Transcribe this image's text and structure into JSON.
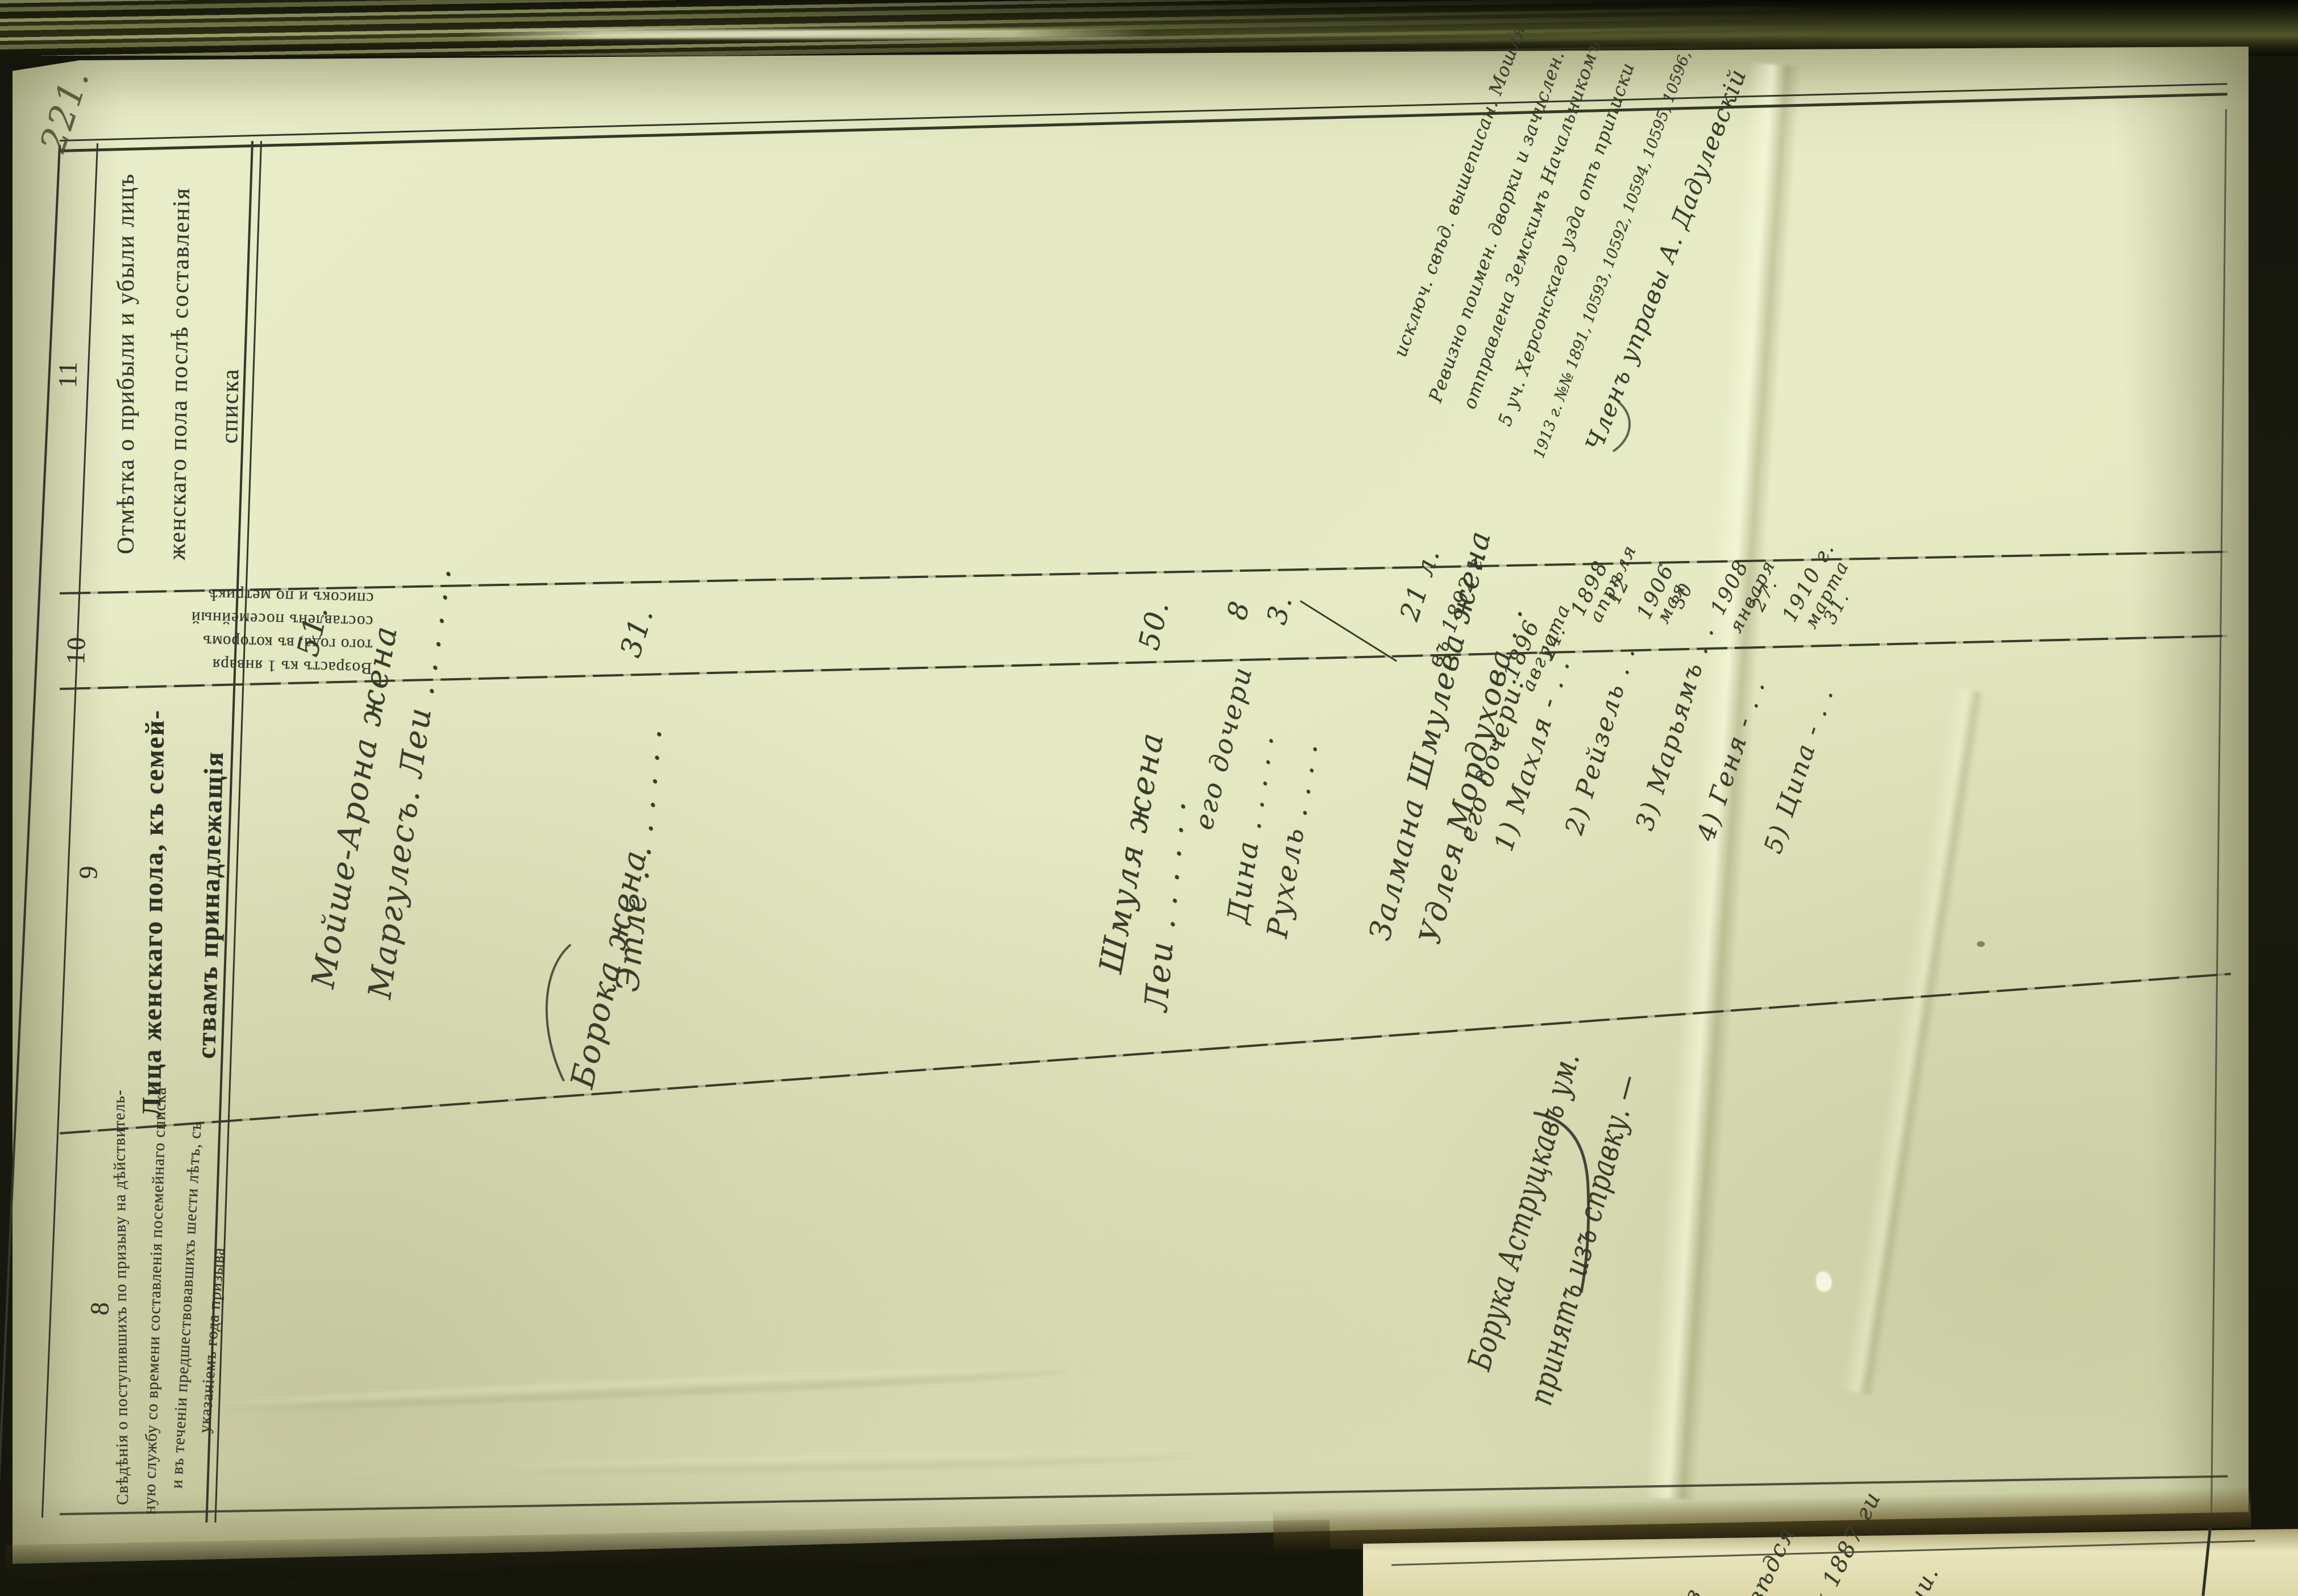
{
  "colors": {
    "paper": "#e7ebc6",
    "ink_print": "#31352a",
    "ink_hand": "#3a3c2b",
    "book_edge": "#3c3f1f",
    "background": "#14150c"
  },
  "page_mark": "221.",
  "columns": {
    "c11": {
      "number": "11",
      "header": [
        "Отмѣтка о прибыли и убыли лицъ",
        "женскаго пола послѣ составленія",
        "списка"
      ]
    },
    "c10": {
      "number": "10",
      "header": [
        "Возрастъ къ 1 января",
        "того года, въ которомъ",
        "составленъ посемейный",
        "списокъ и по метрикѣ"
      ]
    },
    "c9": {
      "number": "9",
      "header": [
        "Лица женскаго пола, къ семей-",
        "ствамъ принадлежащія"
      ]
    },
    "c8": {
      "number": "8",
      "header": [
        "Свѣдѣнія о поступившихъ по призыву на дѣйствитель-",
        "ную службу со времени составленія посемейнаго списка",
        "и въ теченіи предшествовавшихъ шести лѣтъ, съ",
        "указаніемъ года призыва"
      ]
    }
  },
  "entries": {
    "f1": {
      "l1": "Мойше-Арона жена",
      "l2": "Маргулесъ. Леи  .  .  .  .  .  .",
      "age": "51."
    },
    "f2": {
      "l1": "Борока жена",
      "l2": "Этле  .  .  .  .  .  .  .",
      "age": "31."
    },
    "f3": {
      "l1": "Шмуля жена",
      "l2": "Леи  .  .  .  .  .  .",
      "age1": "50.",
      "l3": "его дочери",
      "l4": "Дина  .  .  .  .  .",
      "age2": "8",
      "l5": "Рухель  .  .  .  .",
      "age3": "3."
    },
    "f4": {
      "l1": "Залмана Шмулева жена",
      "age_a": "21 л.",
      "age_b": "въ 1892 г.",
      "l2": "Удлея Мордухова  .  .",
      "l3": "его дочери:",
      "d": [
        {
          "name": "1) Махля  -  .  .",
          "y": "1896",
          "m": "августа",
          "day": "24."
        },
        {
          "name": "2) Рейзель  .  .",
          "y": "1898",
          "m": "апрѣля",
          "day": "12"
        },
        {
          "name": "3) Марьямъ  .  .",
          "y": "1906",
          "m": "мая",
          "day": "30"
        },
        {
          "name": "4) Геня  -  .  .",
          "y": "1908",
          "m": "января",
          "day": "27."
        },
        {
          "name": "5) Ципа  -  .  .",
          "y": "1910 г.",
          "m": "марта",
          "day": "31."
        }
      ]
    }
  },
  "note_c11": [
    "исключ. свѣд. вышеписан. Мошля.",
    "Ревизно поимен. дворки и зачислен.",
    "отправлена Земскимъ Начальникомъ",
    "5 уч. Херсонскаго узда отъ приписки",
    "1913 г. №№ 1891, 10593, 10592, 10594, 10595, 10596,",
    "Членъ управы  А. Дадулевскій"
  ],
  "note_c8": [
    "Борука Аструцкавъ ум.",
    "принятъ изъ справку. —"
  ],
  "next_page": {
    "s1": "з",
    "s2": "вѣдся",
    "s3": "х 1887 ги",
    "s4": "чи."
  }
}
